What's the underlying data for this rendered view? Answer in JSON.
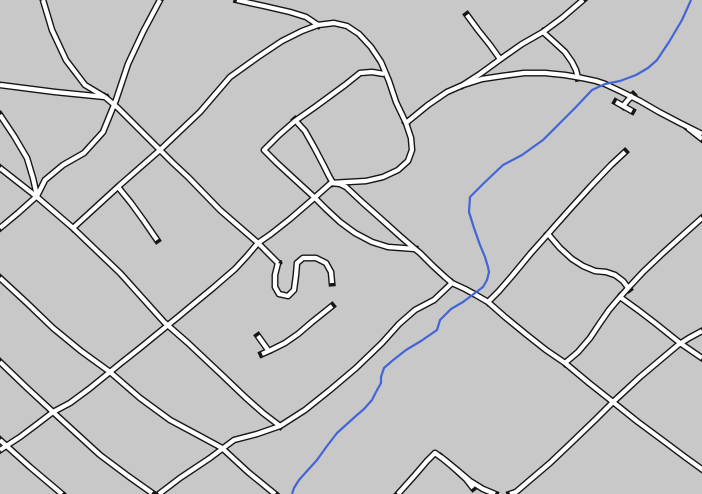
{
  "map": {
    "width": 702,
    "height": 494,
    "background_color": "#c8c8c8",
    "road_casing_color": "#161616",
    "road_fill_color": "#ffffff",
    "river_color": "#4365d6",
    "road_casing_width": 7,
    "road_fill_width": 4.2,
    "river_width": 2.2,
    "roads": [
      {
        "name": "road-nw-curve",
        "points": "43,0 52,30 66,60 85,85 105,97"
      },
      {
        "name": "road-west-connector",
        "points": "0,85 55,92 105,97"
      },
      {
        "name": "road-j1-southeast",
        "points": "105,97 118,108 150,140 173,163 188,177 220,210 258,243 270,255 278,263"
      },
      {
        "name": "road-hook",
        "points": "278,263 275,275 275,287 279,294 288,296 294,290 296,275 297,263 303,258 316,258 326,263 331,272 332,283"
      },
      {
        "name": "road-b-street",
        "points": "160,0 143,32 128,64 116,100 103,132 84,153 63,165 45,180 37,196 18,213 0,228"
      },
      {
        "name": "road-left-curve",
        "points": "0,115 14,136 27,158 33,178 37,196"
      },
      {
        "name": "road-d1-diagonal",
        "points": "0,168 37,197 73,228 120,273 164,322 188,343 222,375 245,397 263,413 280,426"
      },
      {
        "name": "road-highway-west",
        "points": "73,228 120,185 160,150 200,112 230,77 258,57 282,41 302,31 318,25 334,23 347,26 359,34 371,47 381,62 389,81 396,102 406,123"
      },
      {
        "name": "road-top-west",
        "points": "237,0 250,3 264,6 290,12 306,17 318,25"
      },
      {
        "name": "road-east-west",
        "points": "406,123 428,105 447,92 463,85 482,79 502,76 524,73 545,73 565,75 582,78 596,81 605,84 622,92 640,101 659,112 680,123 702,134"
      },
      {
        "name": "road-ne-long",
        "points": "463,85 480,74 502,58 522,44 543,32 562,18 583,0"
      },
      {
        "name": "road-ne-spur",
        "points": "467,15 478,30 490,45 500,59"
      },
      {
        "name": "road-curve-connector",
        "points": "543,32 553,41 565,52 572,62 576,70 578,78"
      },
      {
        "name": "road-t-stub-stem",
        "points": "633,95 628,100 623,106"
      },
      {
        "name": "road-t-stub-bar",
        "points": "616,102 632,111"
      },
      {
        "name": "road-edge-stub",
        "points": "688,128 702,139"
      },
      {
        "name": "road-n-street",
        "points": "625,152 611,165 591,186 571,208 555,226 548,234 531,253 512,276 499,291 488,302"
      },
      {
        "name": "road-n-branch",
        "points": "548,234 560,248 572,259 583,266 595,271 606,272 615,275 623,281 629,289"
      },
      {
        "name": "road-p-street",
        "points": "702,218 684,234 663,253 643,272 630,286 620,297 609,310 600,323 590,338 578,352 565,363"
      },
      {
        "name": "road-x-southeast",
        "points": "620,297 638,310 655,323 680,343 702,358"
      },
      {
        "name": "road-m-main",
        "points": "331,183 340,184 346,187 362,202 380,218 400,236 415,249 420,253 433,266 445,277 452,283 465,289 476,295 488,302 505,317 527,335 546,350 565,363 589,383 613,402 638,422 665,442 685,457 703,470"
      },
      {
        "name": "road-j7-curve",
        "points": "406,123 411,138 412,150 408,161 398,170 383,177 366,181 348,182 331,183"
      },
      {
        "name": "road-x1-j5-street",
        "points": "331,183 312,200 290,219 271,234 258,243 247,256 235,269 213,288 196,302 178,317 162,330 140,348 121,363 110,372 89,389 70,403 53,412 36,425 20,437 0,450"
      },
      {
        "name": "road-l-shaped",
        "points": "384,74 372,72 360,73 345,85 330,96 315,107 295,121 279,135 264,150 277,163 290,175 302,186 314,197 326,209 340,222 355,233 372,242 388,247 402,248 415,249"
      },
      {
        "name": "road-l-branch",
        "points": "295,120 305,131 314,147 323,164 329,176 333,183"
      },
      {
        "name": "road-spur-deadend",
        "points": "118,187 131,203 144,221 157,240"
      },
      {
        "name": "road-se-line",
        "points": "0,278 27,303 53,328 81,351 110,372 140,398 170,420 198,435 222,448 248,472 270,490 275,494"
      },
      {
        "name": "road-sw-line",
        "points": "0,362 26,387 53,412 77,434 100,455 128,476 152,493"
      },
      {
        "name": "road-corner-line",
        "points": "0,440 30,467 62,494"
      },
      {
        "name": "road-branch-sw",
        "points": "452,283 434,300 415,310 399,324 382,343 356,368 330,390 305,410 280,426 257,434 234,440 210,458 180,478 159,494"
      },
      {
        "name": "road-zigzag",
        "points": "332,306 312,322 298,334 285,343 271,350 262,354"
      },
      {
        "name": "road-zigzag-nub",
        "points": "268,350 258,336"
      },
      {
        "name": "road-lambda",
        "points": "398,494 415,475 427,461 435,453 446,461 457,470 470,481 483,489 495,494"
      },
      {
        "name": "road-lambda-spur",
        "points": "441,457 455,469 466,479 473,488"
      },
      {
        "name": "road-se-cross",
        "points": "702,331 689,338 678,345 659,361 640,377 626,390 613,402 596,419 570,444 550,463 530,480 516,492 510,494"
      }
    ],
    "river": {
      "name": "river-stream",
      "points": "691,0 682,20 669,42 657,60 648,68 636,75 620,81 605,84 592,90 575,108 560,123 543,140 522,155 503,165 484,183 470,197 469,212 474,228 480,245 485,257 488,267 489,272 487,280 483,287 475,293 463,302 451,309 440,320 437,330 421,341 406,350 392,361 384,368 381,377 381,383 376,392 372,400 364,409 357,415 347,424 337,433 327,446 317,460 307,471 299,480 294,488 292,494"
    }
  }
}
